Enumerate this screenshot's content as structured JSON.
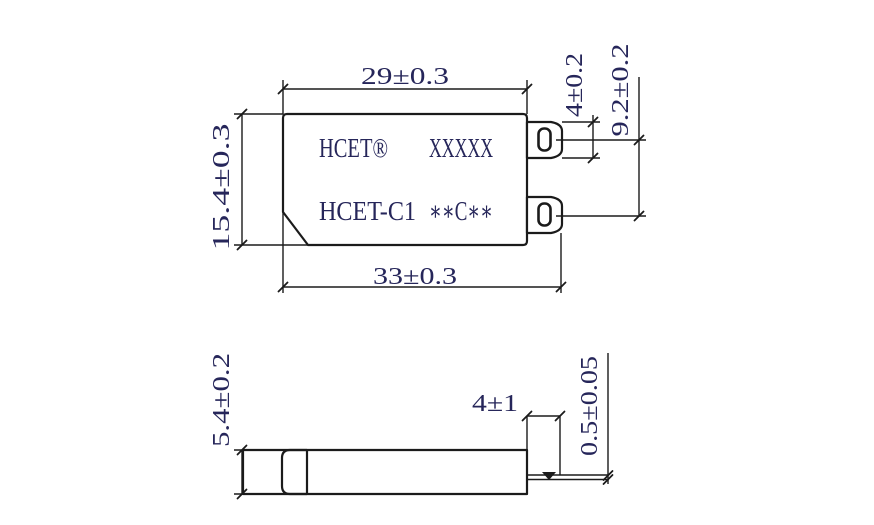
{
  "page": {
    "background": "#ffffff"
  },
  "drawing": {
    "marking": {
      "line1_left": "HCET®",
      "line1_right": "XXXXX",
      "line2_left": "HCET-C1",
      "line2_right": "∗∗C∗∗"
    },
    "top_view": {
      "width_top": "29±0.3",
      "height_left": "15.4±0.3",
      "width_bottom": "33±0.3",
      "terminal_width": "4±0.2",
      "terminal_pitch": "9.2±0.2"
    },
    "side_view": {
      "body_thickness": "5.4±0.2",
      "terminal_length": "4±1",
      "terminal_thickness": "0.5±0.05"
    },
    "colors": {
      "line": "#1b1b1b",
      "text": "#26265a"
    }
  }
}
